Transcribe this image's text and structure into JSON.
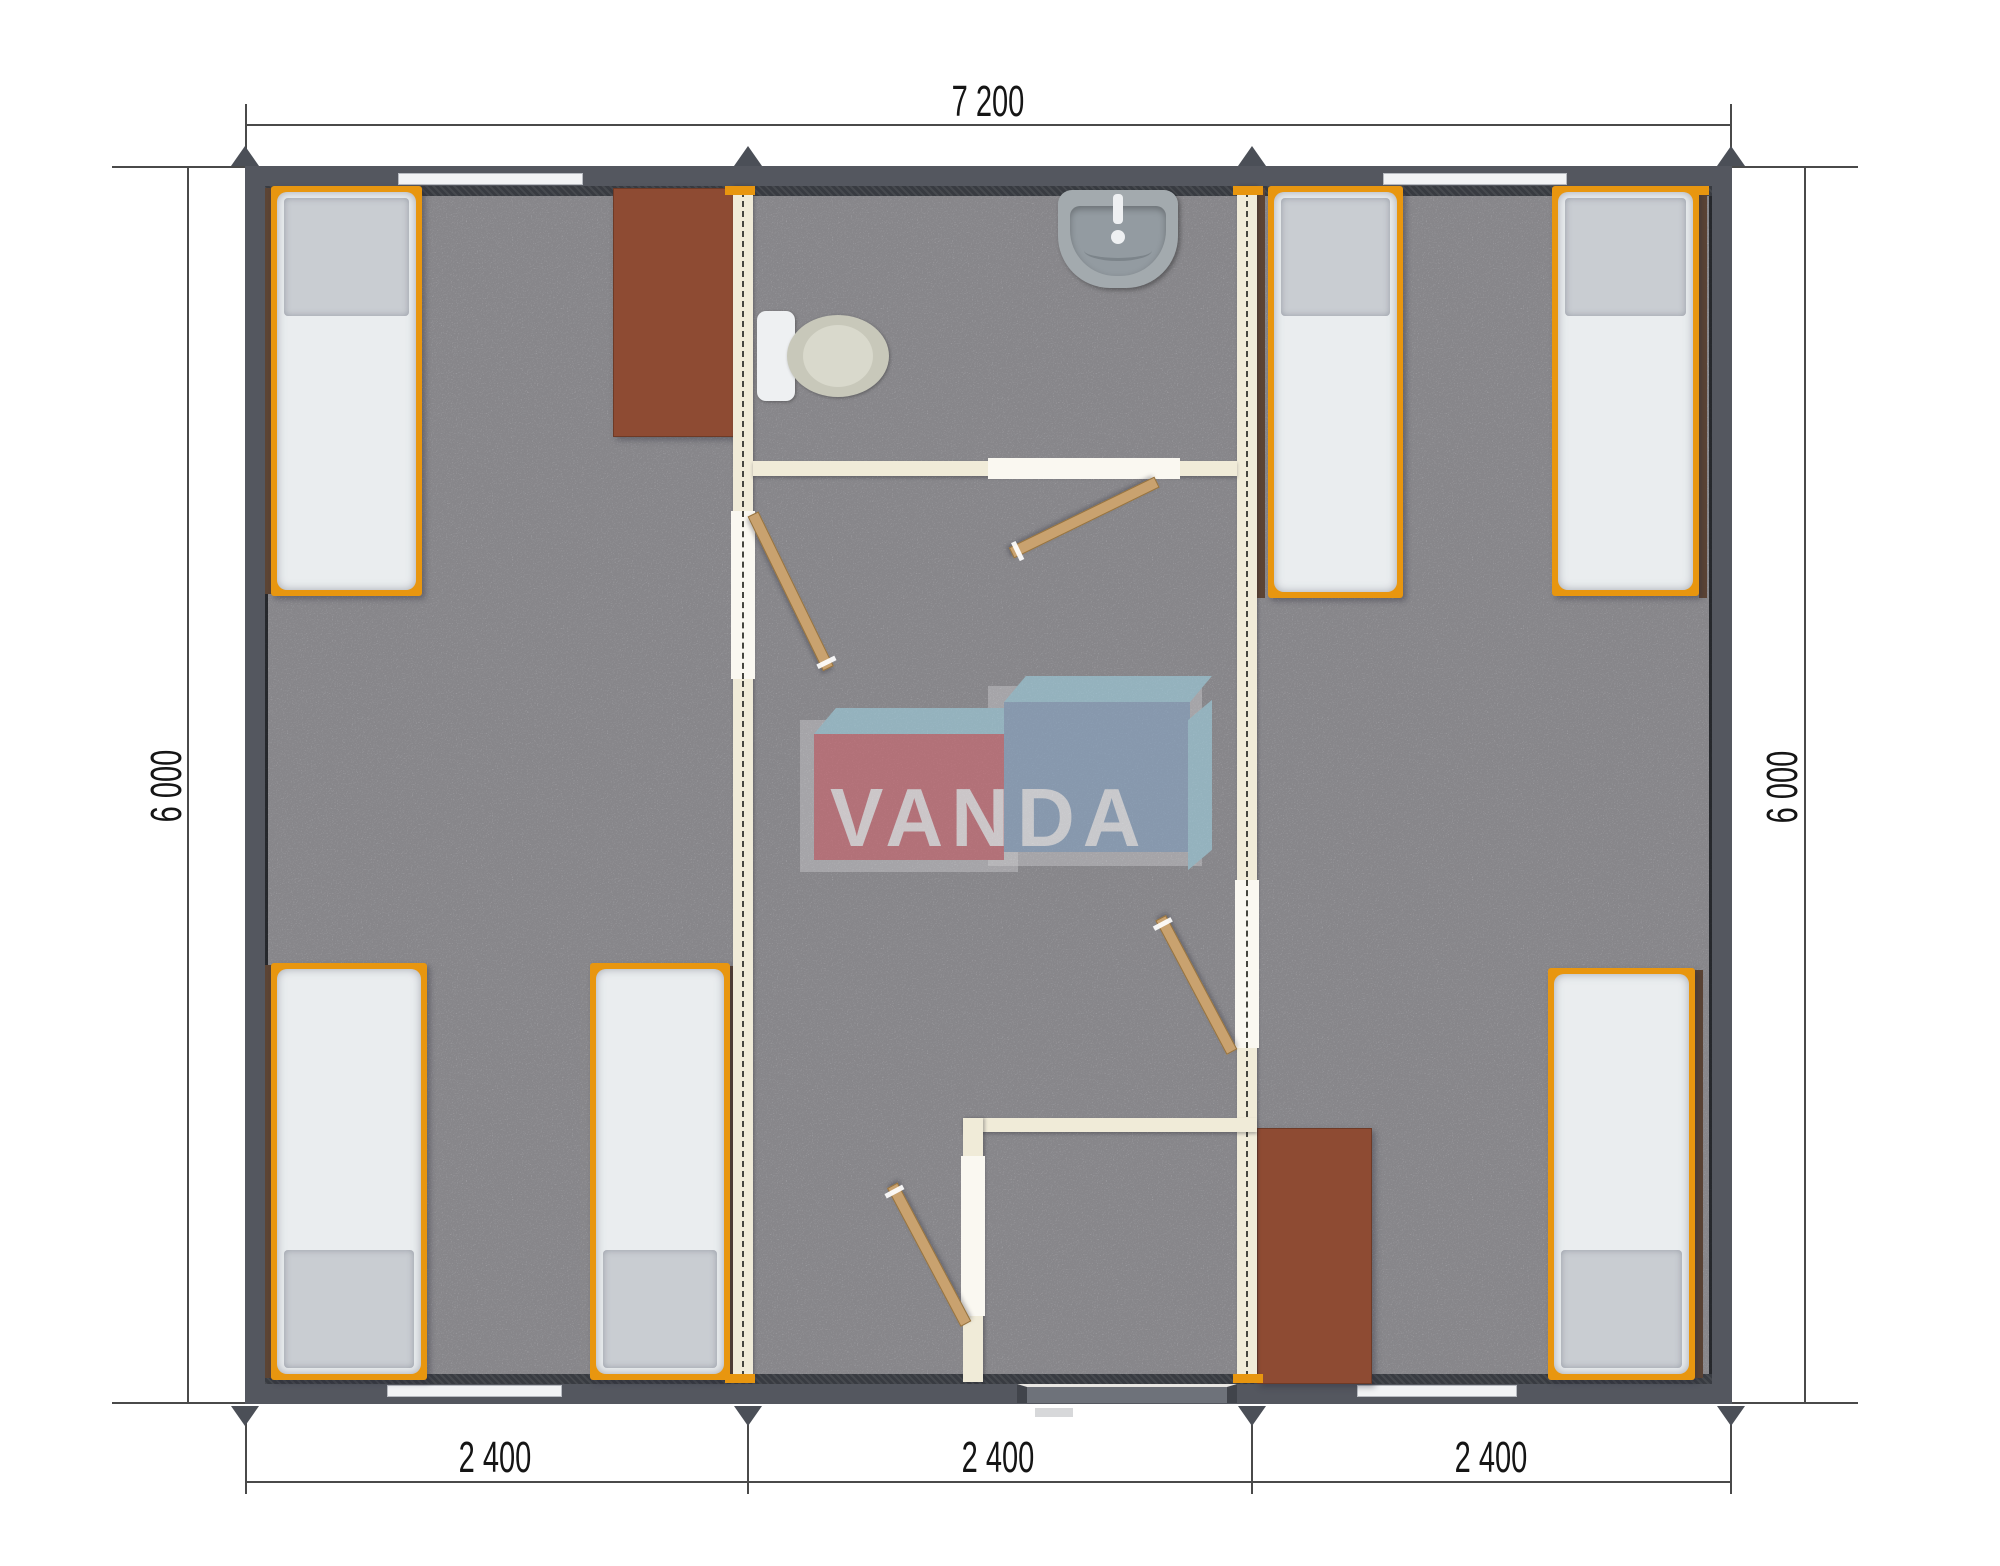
{
  "document": {
    "type": "floor-plan-render",
    "background": "#ffffff"
  },
  "watermark": {
    "text": "VANDA"
  },
  "dimensions": {
    "top": {
      "label": "7 200"
    },
    "left": {
      "label": "6 000"
    },
    "right": {
      "label": "6 000"
    },
    "bottom": [
      {
        "label": "2 400"
      },
      {
        "label": "2 400"
      },
      {
        "label": "2 400"
      }
    ]
  },
  "colors": {
    "wall": "#54575f",
    "wall_inner": "#383b41",
    "floor": "#bcbbc0",
    "partition": "#f0ebd8",
    "partition_opening": "#faf8f1",
    "door_wood": "#c9a26f",
    "bed_frame": "#e8960f",
    "mattress": "#eaedef",
    "pillow": "#c9cdd2",
    "desk": "#8e4b33",
    "window_dark": "#5c4434",
    "window_light": "#f2f3f5",
    "fixture": "#a3aaae",
    "toilet_bowl": "#c8c8ba",
    "dim_line": "#4a4a4a",
    "arrow": "#4b4f57",
    "wm_red": "#d2626c",
    "wm_blue": "#87a6c7",
    "wm_light_blue": "#9fd2e3"
  },
  "contents": {
    "modules": 3,
    "rooms": [
      "bedroom-left",
      "hallway-with-bathroom",
      "bedroom-right"
    ],
    "fixtures": [
      "toilet",
      "washbasin"
    ],
    "furniture_counts": {
      "beds": 6,
      "desks": 2,
      "interior_doors": 4,
      "entrance_doors": 1
    }
  }
}
